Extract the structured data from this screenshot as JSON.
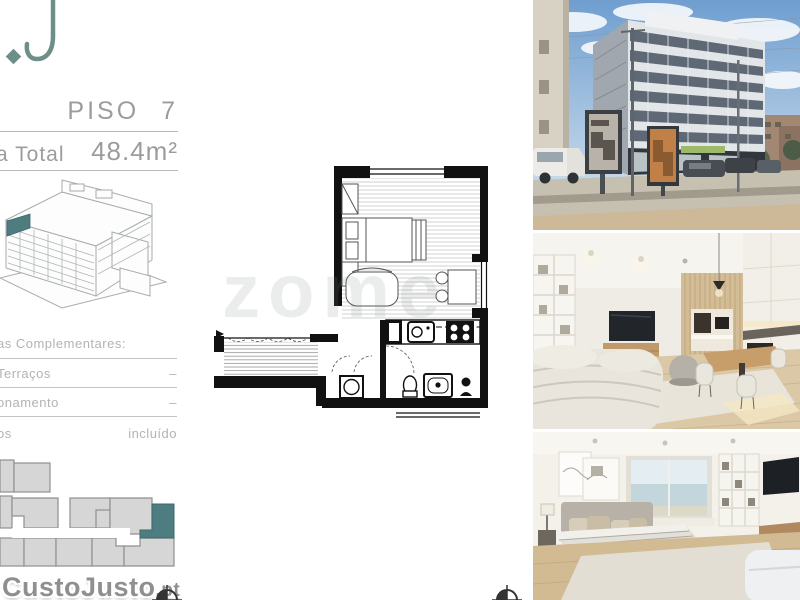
{
  "colors": {
    "accent_teal": "#4e7d81",
    "text_gray": "#9c9c9c",
    "wall_black": "#111111"
  },
  "logo": {
    "letter": "J"
  },
  "header": {
    "floor": "PISO 7",
    "area_label": "a Total",
    "area_value": "48.4m²"
  },
  "areas": {
    "title": "as Complementares:",
    "rows": [
      {
        "label": "Terraços",
        "value": "–"
      },
      {
        "label": "onamento",
        "value": "–"
      },
      {
        "label": "os",
        "value": "incluído"
      }
    ]
  },
  "watermarks": {
    "listing_site_main": "CustoJusto",
    "listing_site_suffix": ".pt",
    "agency": "zome"
  }
}
